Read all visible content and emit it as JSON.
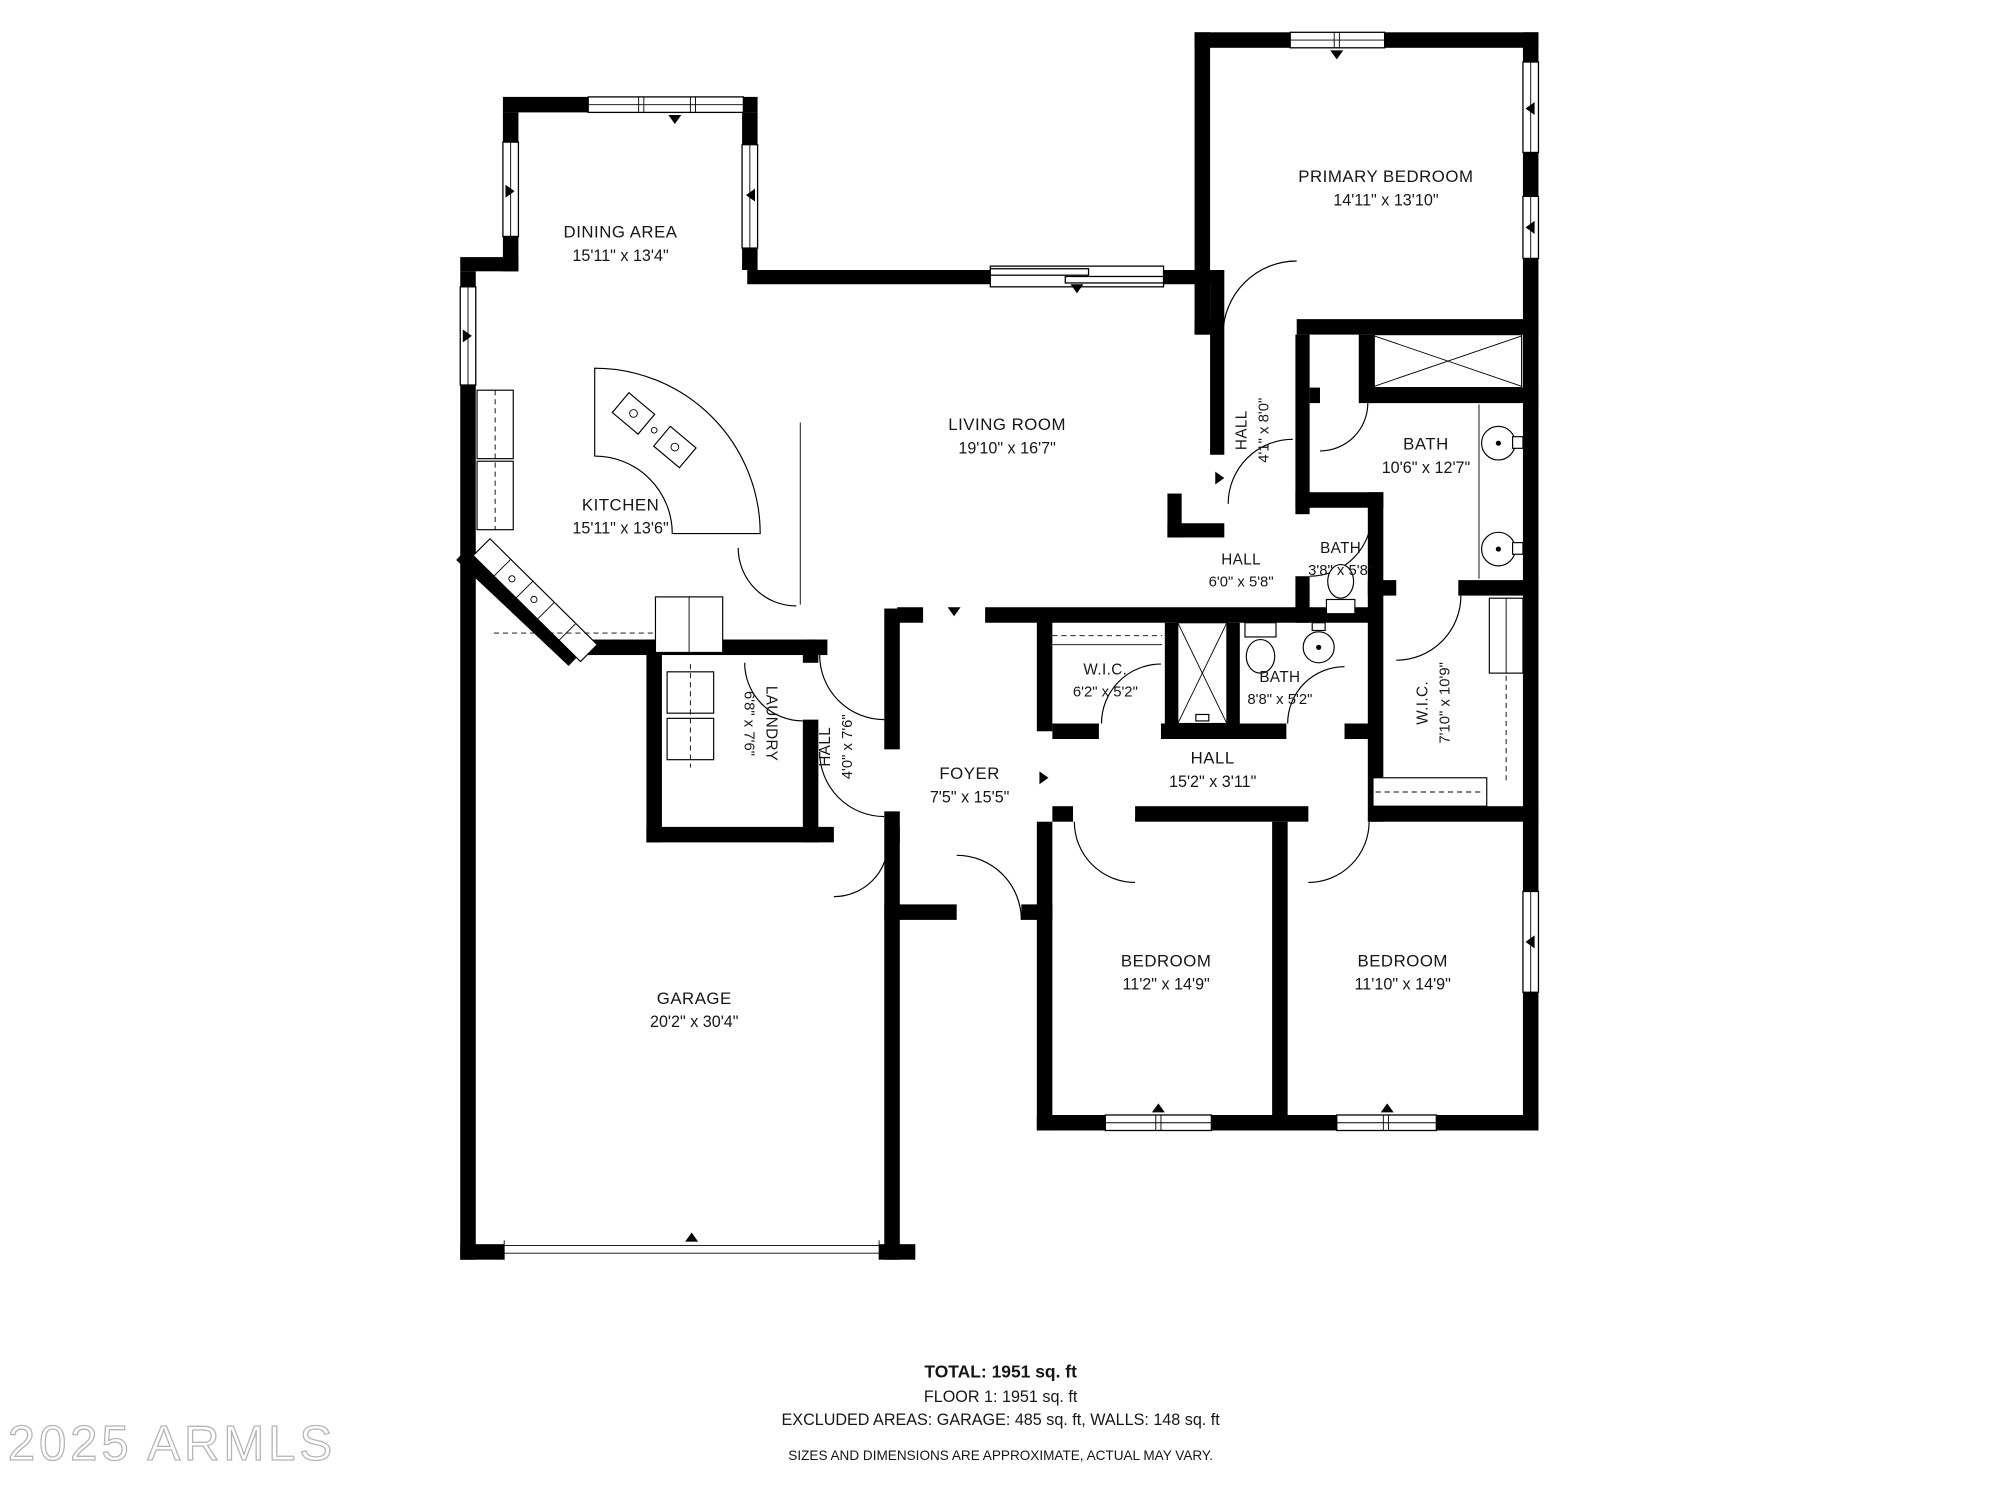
{
  "watermark": "2025 ARMLS",
  "rooms": {
    "dining": {
      "name": "DINING AREA",
      "dims": "15'11\" x 13'4\""
    },
    "primary_bedroom": {
      "name": "PRIMARY BEDROOM",
      "dims": "14'11\" x 13'10\""
    },
    "living": {
      "name": "LIVING ROOM",
      "dims": "19'10\" x 16'7\""
    },
    "kitchen": {
      "name": "KITCHEN",
      "dims": "15'11\" x 13'6\""
    },
    "hall_upper": {
      "name": "HALL",
      "dims": "4'1\" x 8'0\""
    },
    "bath_primary": {
      "name": "BATH",
      "dims": "10'6\" x 12'7\""
    },
    "hall_mid": {
      "name": "HALL",
      "dims": "6'0\" x 5'8\""
    },
    "bath_small": {
      "name": "BATH",
      "dims": "3'8\" x 5'8\""
    },
    "wic_small": {
      "name": "W.I.C.",
      "dims": "6'2\" x 5'2\""
    },
    "bath_hall": {
      "name": "BATH",
      "dims": "8'8\" x 5'2\""
    },
    "wic_large": {
      "name": "W.I.C.",
      "dims": "7'10\" x 10'9\""
    },
    "laundry": {
      "name": "LAUNDRY",
      "dims": "6'8\" x 7'6\""
    },
    "hall_laundry": {
      "name": "HALL",
      "dims": "4'0\" x 7'6\""
    },
    "foyer": {
      "name": "FOYER",
      "dims": "7'5\" x 15'5\""
    },
    "hall_bedrooms": {
      "name": "HALL",
      "dims": "15'2\" x 3'11\""
    },
    "garage": {
      "name": "GARAGE",
      "dims": "20'2\" x 30'4\""
    },
    "bedroom_one": {
      "name": "BEDROOM",
      "dims": "11'2\" x 14'9\""
    },
    "bedroom_two": {
      "name": "BEDROOM",
      "dims": "11'10\" x 14'9\""
    }
  },
  "footer": {
    "total": "TOTAL: 1951 sq. ft",
    "floor": "FLOOR 1: 1951 sq. ft",
    "excluded": "EXCLUDED AREAS: GARAGE: 485 sq. ft, WALLS: 148 sq. ft",
    "disclaimer": "SIZES AND DIMENSIONS ARE APPROXIMATE, ACTUAL MAY VARY."
  }
}
